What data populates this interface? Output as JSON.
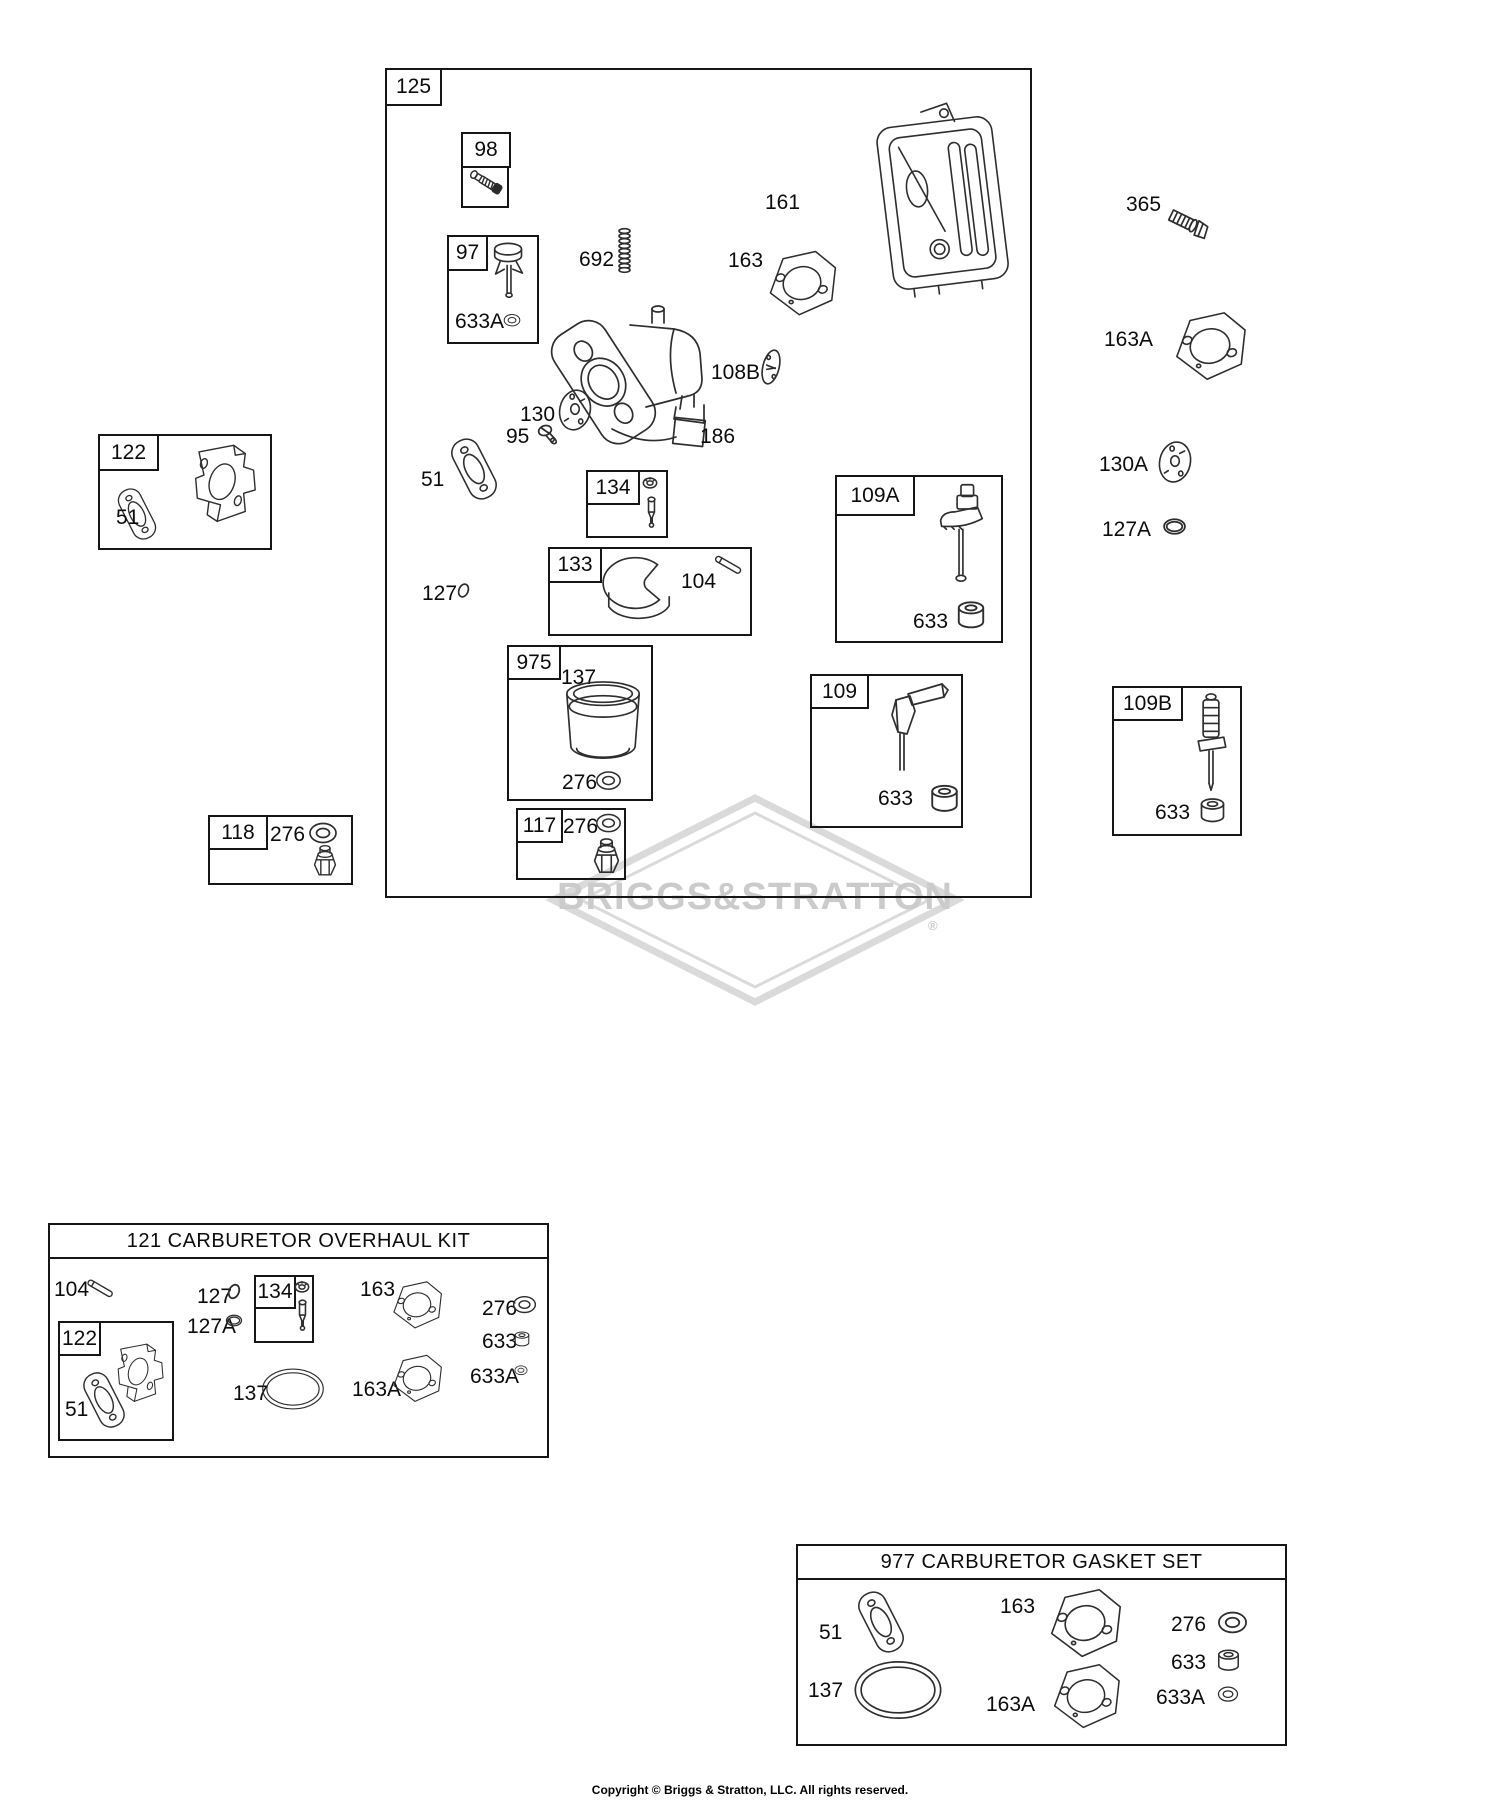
{
  "watermark": {
    "text": "BRIGGS&STRATTON",
    "reg": "®"
  },
  "copyright": "Copyright © Briggs & Stratton, LLC. All rights reserved.",
  "box125": {
    "label": "125",
    "box98": {
      "label": "98"
    },
    "box97": {
      "label": "97",
      "p633A": "633A"
    },
    "p692": "692",
    "p161": "161",
    "p163": "163",
    "p108B": "108B",
    "p130": "130",
    "p95": "95",
    "p186": "186",
    "p51": "51",
    "p127": "127",
    "box134": {
      "label": "134"
    },
    "box133": {
      "label": "133",
      "p104": "104"
    },
    "box975": {
      "label": "975",
      "p137": "137",
      "p276": "276"
    },
    "box117": {
      "label": "117",
      "p276": "276"
    },
    "box109A": {
      "label": "109A",
      "p633": "633"
    },
    "box109": {
      "label": "109",
      "p633": "633"
    }
  },
  "box122": {
    "label": "122",
    "p51": "51"
  },
  "box118": {
    "label": "118",
    "p276": "276"
  },
  "right": {
    "p365": "365",
    "p163A": "163A",
    "p130A": "130A",
    "p127A": "127A",
    "box109B": {
      "label": "109B",
      "p633": "633"
    }
  },
  "kit121": {
    "title": "121 CARBURETOR OVERHAUL KIT",
    "p104": "104",
    "p127": "127",
    "p127A": "127A",
    "box134": {
      "label": "134"
    },
    "p163": "163",
    "p276": "276",
    "p633": "633",
    "p633A": "633A",
    "p137": "137",
    "p163A": "163A",
    "box122": {
      "label": "122",
      "p51": "51"
    }
  },
  "set977": {
    "title": "977 CARBURETOR GASKET SET",
    "p51": "51",
    "p137": "137",
    "p163": "163",
    "p163A": "163A",
    "p276": "276",
    "p633": "633",
    "p633A": "633A"
  }
}
